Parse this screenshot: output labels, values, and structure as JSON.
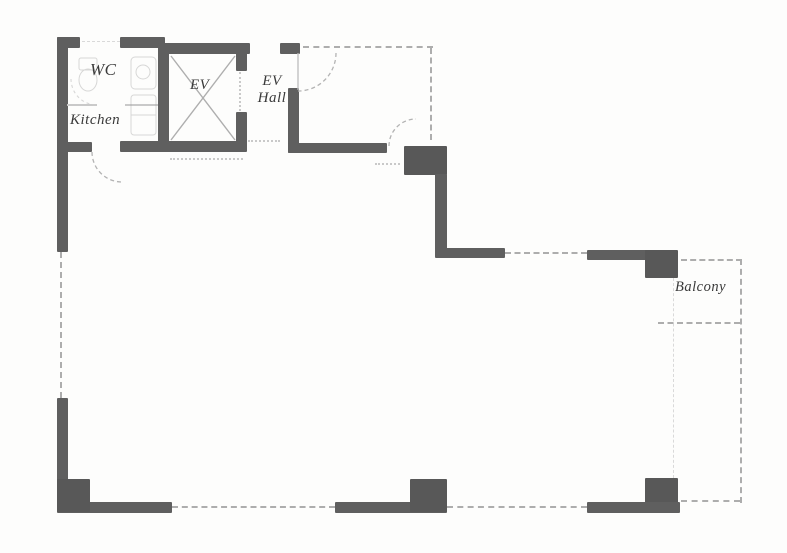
{
  "plan_labels": {
    "wc": "WC",
    "kitchen": "Kitchen",
    "elevator": "EV",
    "ev_hall_line1": "EV",
    "ev_hall_line2": "Hall",
    "balcony": "Balcony"
  },
  "colors": {
    "wall": "#5f5f5f",
    "pillar": "#585858",
    "dashed": "#adadad",
    "faint": "#c9c9c9",
    "arc": "#b3b3b3",
    "label": "#3a3a3a",
    "bg": "#fdfdfc"
  }
}
